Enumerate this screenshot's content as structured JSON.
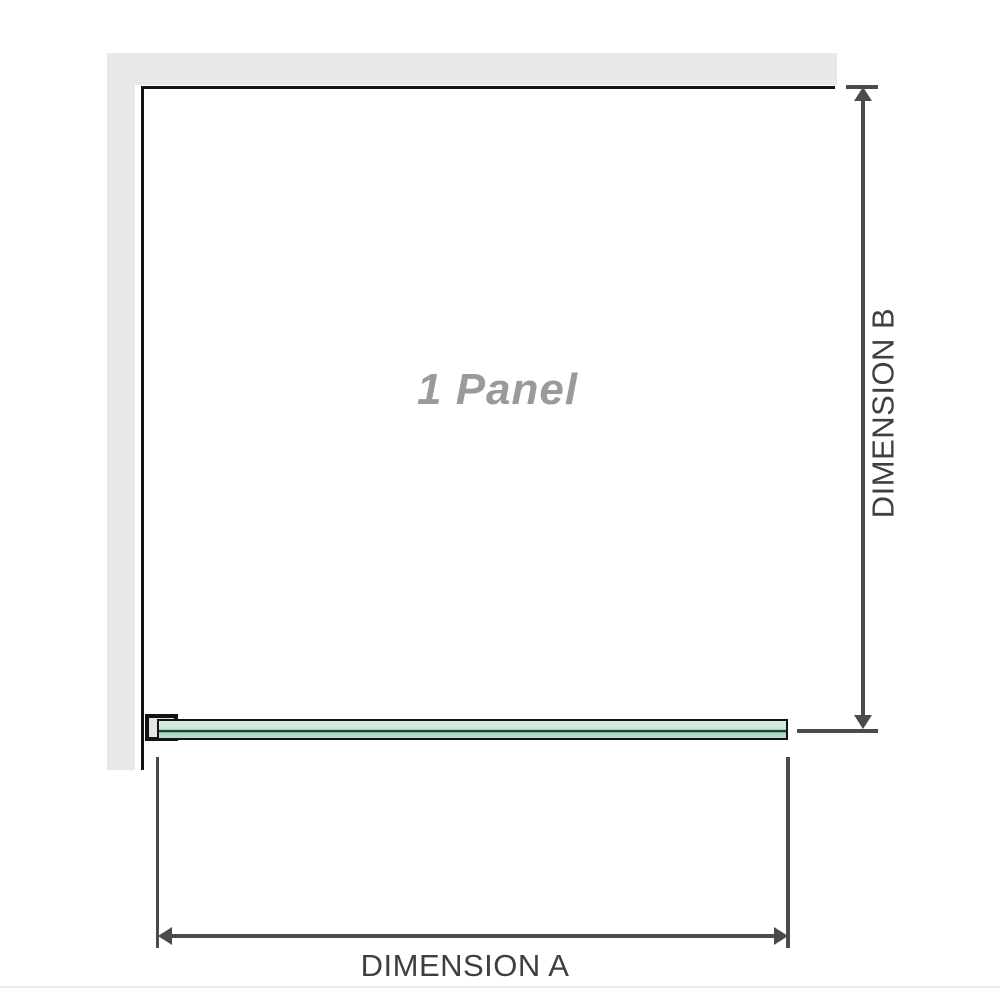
{
  "diagram": {
    "panel_label": "1 Panel",
    "dimension_a_label": "DIMENSION A",
    "dimension_b_label": "DIMENSION B"
  },
  "icons": {
    "arrow_up_icon": "css-triangle-up",
    "arrow_down_icon": "css-triangle-down",
    "arrow_left_icon": "css-triangle-left",
    "arrow_right_icon": "css-triangle-right"
  },
  "colors": {
    "wall": "#e8e8e8",
    "bracket_fill": "#e4e4e4",
    "outline": "#131313",
    "dimension": "#4b4b4b",
    "dim_text": "#3f3f3f",
    "label": "#9a9a9a",
    "glass_top": "#d8efe2",
    "glass_upper": "#c7e9d6",
    "glass_line": "#1b3d2e",
    "glass_lower": "#a8d9c0",
    "glass_bottom": "#b5e0ca",
    "faint_edge": "#ececec"
  }
}
